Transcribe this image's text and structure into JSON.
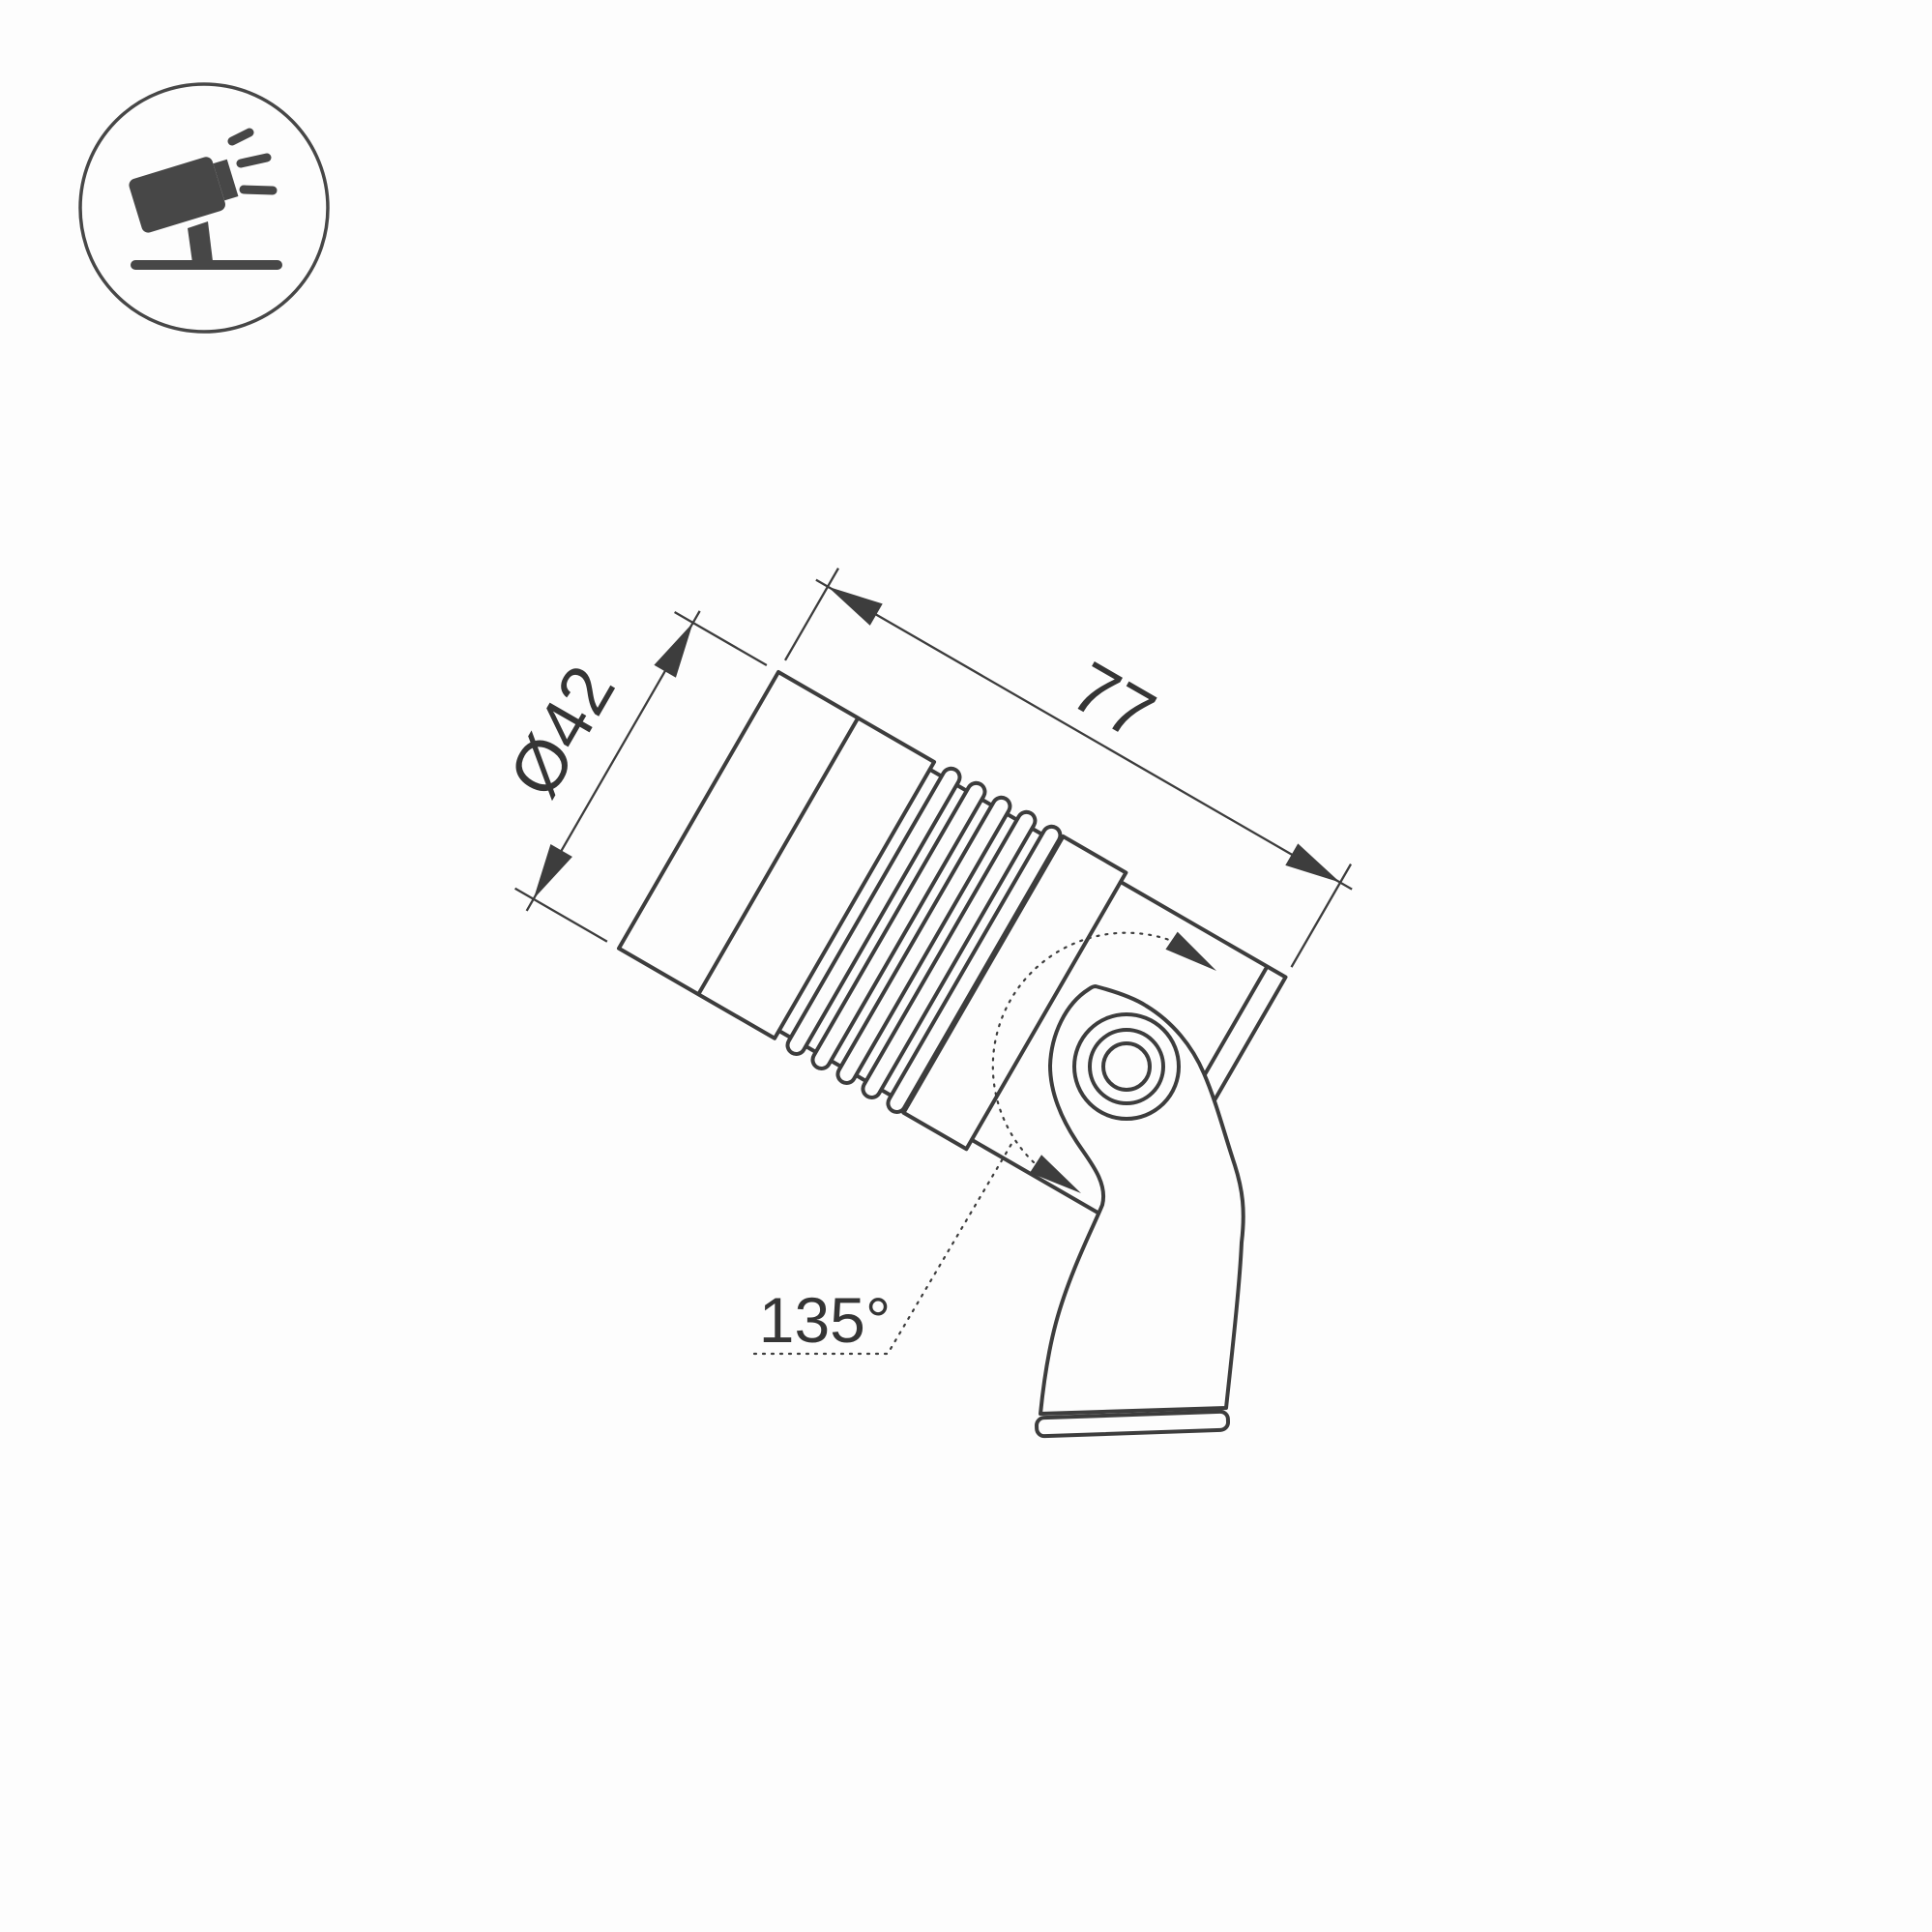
{
  "icon": {
    "label": "tilted-spotlight-on-ground"
  },
  "annotations": {
    "diameter": "Ø42",
    "length": "77",
    "rotation_angle": "135°"
  },
  "drawing": {
    "type": "technical-dimension-drawing",
    "subject": "ground-mounted adjustable spotlight luminaire",
    "body_tilt_deg": 30,
    "fin_count": 5
  },
  "colors": {
    "line": "#3d3d3d",
    "icon": "#474747",
    "text": "#353535",
    "background": "#fdfdfd"
  }
}
